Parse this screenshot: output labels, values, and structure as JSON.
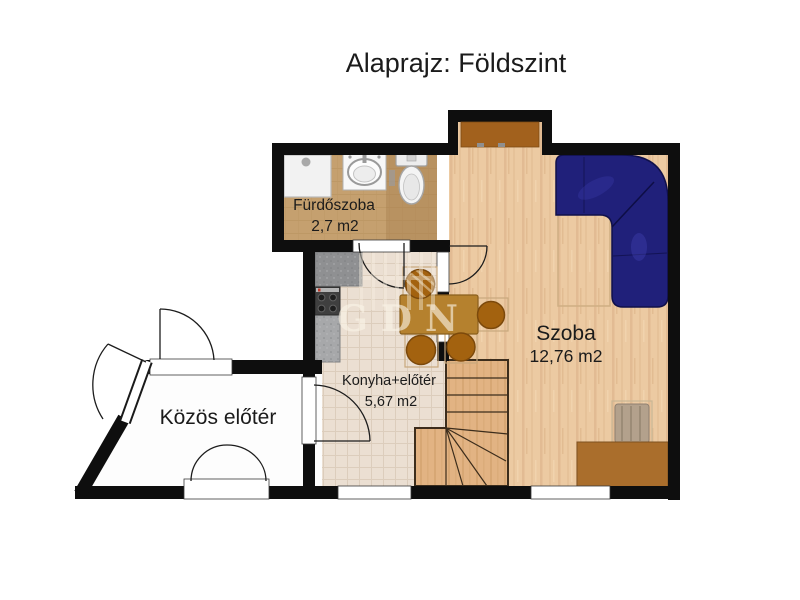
{
  "title": "Alaprajz: Földszint",
  "watermark": "GDN",
  "rooms": {
    "bathroom": {
      "name": "Fürdőszoba",
      "area": "2,7 m2"
    },
    "living": {
      "name": "Szoba",
      "area": "12,76 m2"
    },
    "kitchen": {
      "name": "Konyha+előtér",
      "area": "5,67 m2"
    },
    "common_hall": {
      "name": "Közös előtér"
    }
  },
  "colors": {
    "wall": "#0e0e0e",
    "bathroom_floor": "#c5a06f",
    "kitchen_floor": "#ebdfd2",
    "room_floor": "#eccaa2",
    "stair_wood": "#e2b383",
    "sofa_navy": "#20207a",
    "table_brown": "#b5812e",
    "chair_brown": "#a3620f",
    "desk_brown": "#aa6e2c",
    "niche_door_brown": "#a2611d",
    "counter_gray": "#9b9c9e",
    "hall_floor": "#fdfdfd"
  }
}
